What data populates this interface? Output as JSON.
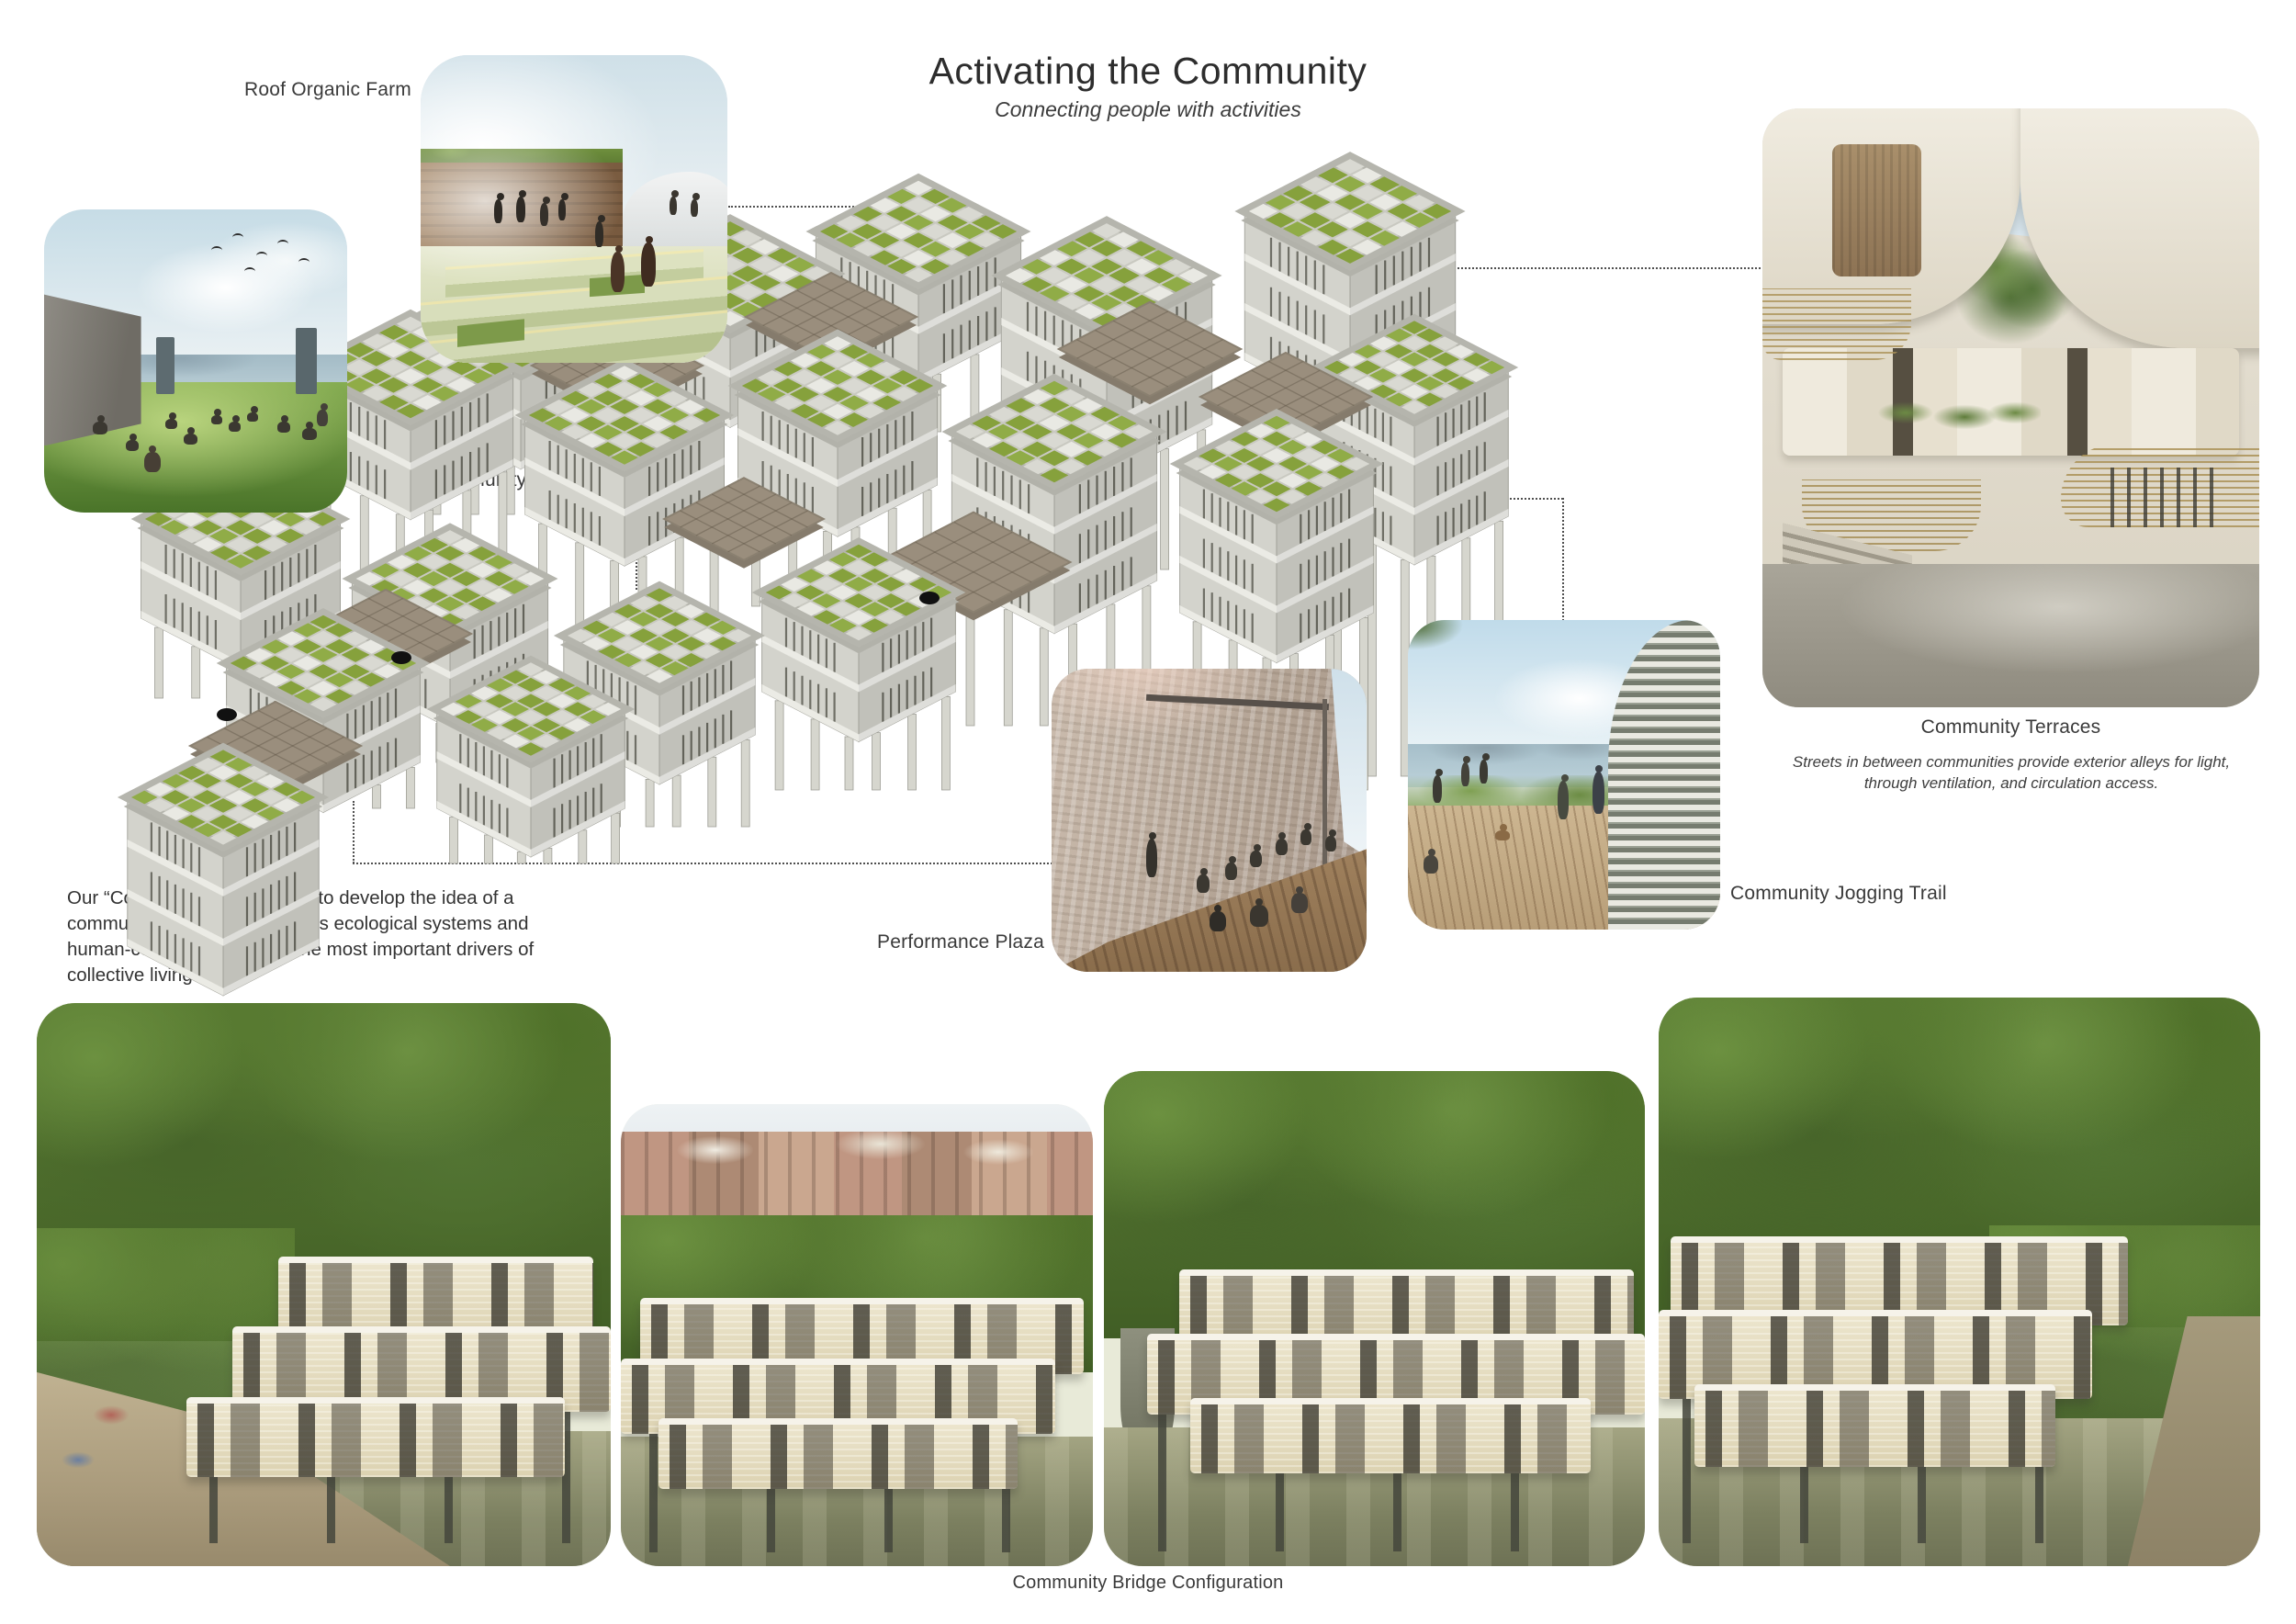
{
  "header": {
    "title": "Activating the Community",
    "subtitle": "Connecting people with activities"
  },
  "intro": {
    "text": "Our “Core Community” led us to develop the idea of a community bridge which places ecological systems and human-centered design as the most important drivers of collective living."
  },
  "callouts": {
    "roof_farm": {
      "label": "Roof Organic Farm"
    },
    "leisure_park": {
      "label": "Leisure Community Park"
    },
    "community_terraces": {
      "label": "Community Terraces",
      "caption": "Streets in between communities provide exterior alleys for light, through ventilation, and circulation access."
    },
    "performance_plaza": {
      "label": "Performance Plaza"
    },
    "jogging_trail": {
      "label": "Community Jogging Trail"
    },
    "bridge": {
      "label": "Community Bridge Configuration"
    }
  },
  "colors": {
    "roof_green_a": "#86a13c",
    "roof_green_b": "#90ac47",
    "roof_tile_gray": "#d9d9d2",
    "roof_tile_light": "#e9e9e3",
    "concrete_face_light": "#d3d3cc",
    "concrete_face_dark": "#c1c1ba",
    "slab_band": "#ebebe5",
    "deck_taupe": "#9a8e7d",
    "leg_gray": "#d6d6ce",
    "leader_dotted": "#4f4f4f",
    "text_gray": "#3a3a3a"
  }
}
